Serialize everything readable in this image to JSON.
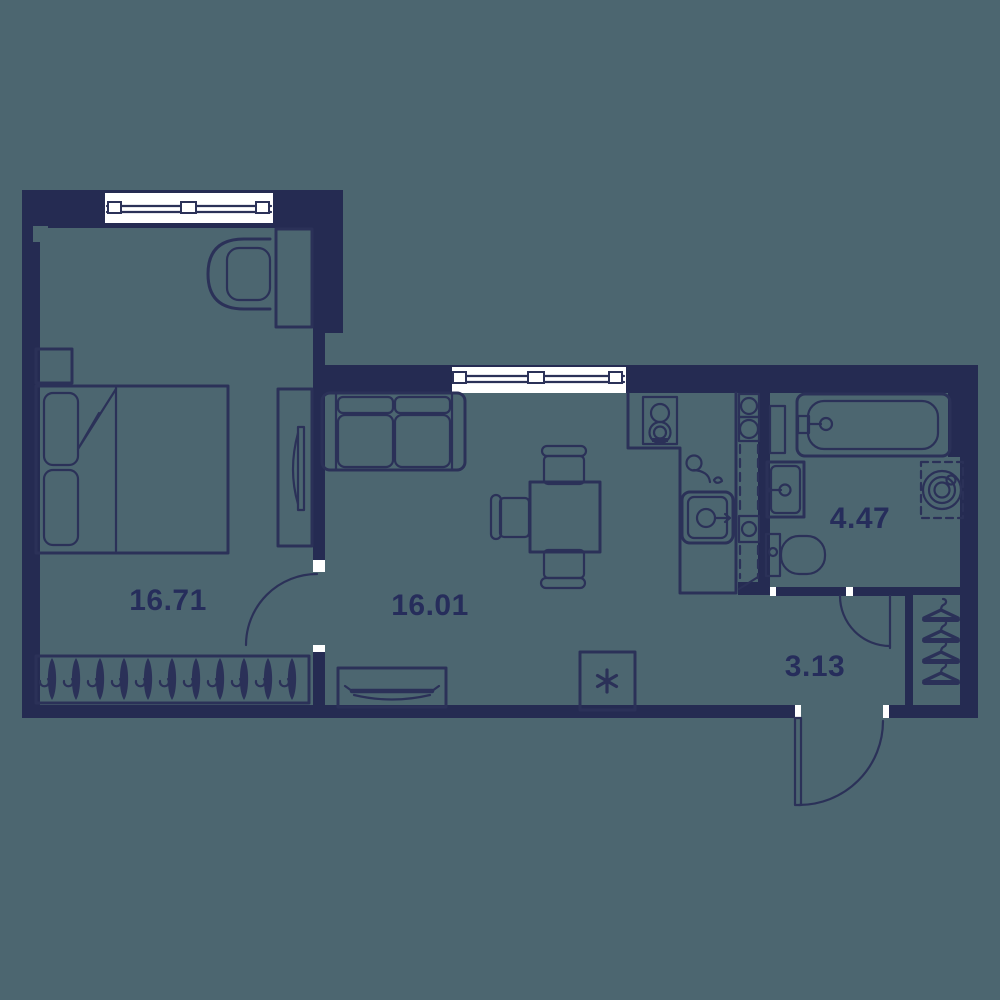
{
  "plan": {
    "type": "apartment-floor-plan",
    "rooms": [
      {
        "id": "bedroom",
        "area_label": "16.71"
      },
      {
        "id": "living-kitchen",
        "area_label": "16.01"
      },
      {
        "id": "bathroom",
        "area_label": "4.47"
      },
      {
        "id": "hallway",
        "area_label": "3.13"
      }
    ]
  },
  "colors": {
    "floor": "#4C6670",
    "wall": "#252B52",
    "line": "#2B3158",
    "label": "#262D5B",
    "white": "#FFFFFF"
  }
}
